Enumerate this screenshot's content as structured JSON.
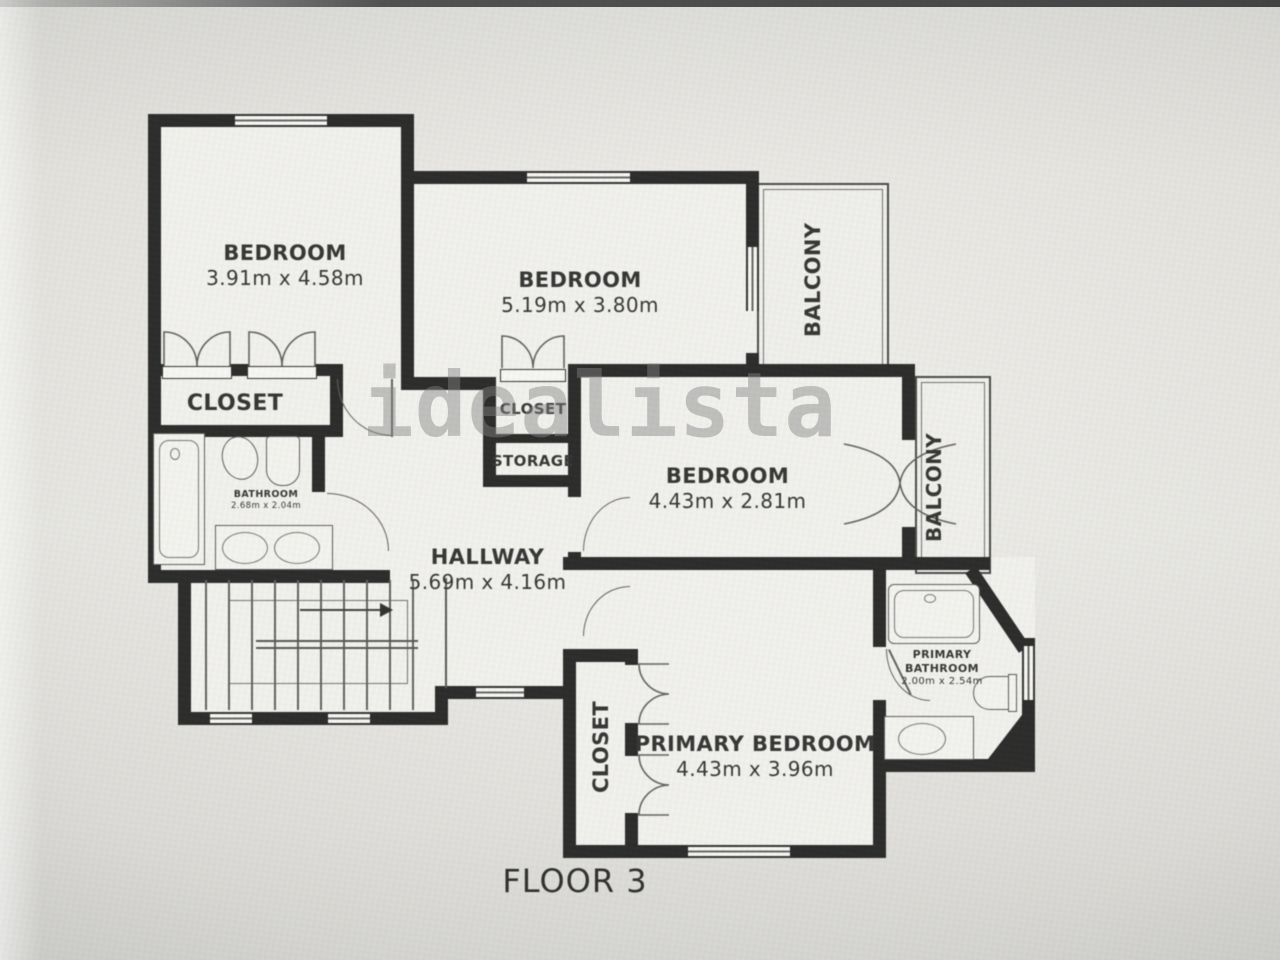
{
  "meta": {
    "floor_label": "FLOOR 3",
    "watermark": "idealista"
  },
  "rooms": {
    "bedroom_top_left": {
      "name": "BEDROOM",
      "dims": "3.91m x 4.58m"
    },
    "bedroom_top": {
      "name": "BEDROOM",
      "dims": "5.19m x 3.80m"
    },
    "bedroom_middle": {
      "name": "BEDROOM",
      "dims": "4.43m x 2.81m"
    },
    "primary_bedroom": {
      "name": "PRIMARY BEDROOM",
      "dims": "4.43m x 3.96m"
    },
    "hallway": {
      "name": "HALLWAY",
      "dims": "5.69m x 4.16m"
    },
    "bathroom": {
      "name": "BATHROOM",
      "dims": "2.68m x 2.04m"
    },
    "primary_bathroom": {
      "name": "PRIMARY BATHROOM",
      "dims": "2.00m x 2.54m"
    },
    "closet_top_left": {
      "name": "CLOSET"
    },
    "closet_middle": {
      "name": "CLOSET"
    },
    "storage": {
      "name": "STORAGE"
    },
    "closet_primary": {
      "name": "CLOSET"
    },
    "balcony_top": {
      "name": "BALCONY"
    },
    "balcony_right": {
      "name": "BALCONY"
    }
  },
  "colors": {
    "wall": "#1b1b1b",
    "thin_line": "#4a4a4a",
    "text": "#262626",
    "watermark": "#7a7a7a"
  }
}
